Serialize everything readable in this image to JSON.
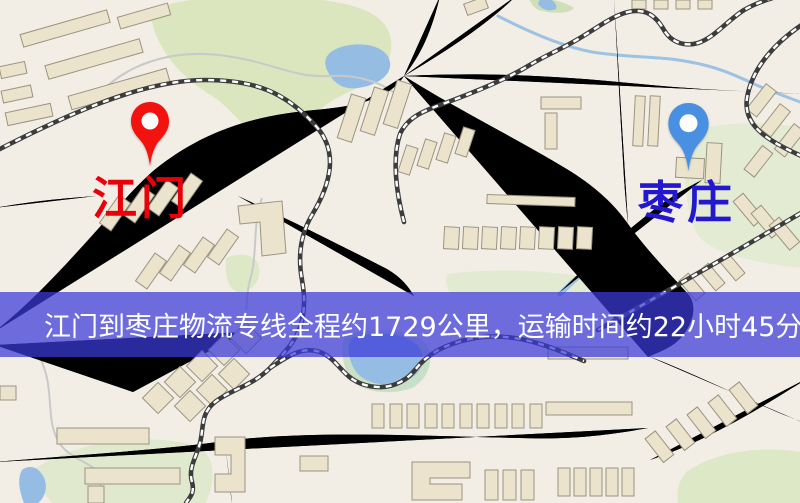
{
  "map": {
    "markers": {
      "origin": {
        "name": "江门",
        "text_color": "#e8000a",
        "pin_color": "#f2130e"
      },
      "destination": {
        "name": "枣庄",
        "text_color": "#2418cf",
        "pin_color": "#4a90e2"
      }
    },
    "banner": {
      "text": "江门到枣庄物流专线全程约1729公里，运输时间约22小时45分钟.",
      "background": "rgba(58,58,218,0.72)",
      "text_color": "#ffffff"
    },
    "colors": {
      "background": "#f2eee6",
      "road_fill": "#f7d474",
      "road_casing": "#e2b64e",
      "water": "#95bce2",
      "park": "#dbe6bf",
      "building_fill": "#ebe3cc",
      "building_outline": "#9a947f",
      "railway": "#3c3c3c"
    }
  }
}
